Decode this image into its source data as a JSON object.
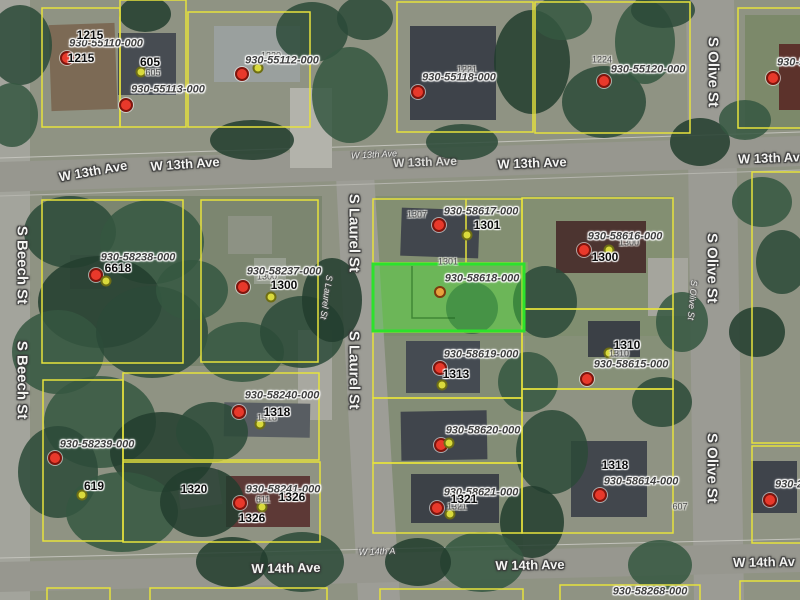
{
  "app": {
    "view": "aerial-parcel-map",
    "selected_parcel_id": "930-58618-000"
  },
  "colors": {
    "parcel_line": "#e6e23c",
    "selected_parcel_stroke": "#2ce22c",
    "selected_parcel_fill": "rgba(70,215,60,0.38)",
    "red_marker": "#e8392b",
    "yellow_marker": "#d9da3c",
    "selected_marker": "#e8a13c"
  },
  "parcel_ids": [
    {
      "text": "930-55110-000"
    },
    {
      "text": "930-55113-000"
    },
    {
      "text": "930-55112-000"
    },
    {
      "text": "930-55118-000"
    },
    {
      "text": "930-55120-000"
    },
    {
      "text": "930-5"
    },
    {
      "text": "930-58238-000"
    },
    {
      "text": "930-58237-000"
    },
    {
      "text": "930-58617-000"
    },
    {
      "text": "930-58616-000"
    },
    {
      "text": "930-58618-000"
    },
    {
      "text": "930-58619-000"
    },
    {
      "text": "930-58615-000"
    },
    {
      "text": "930-58620-000"
    },
    {
      "text": "930-58621-000"
    },
    {
      "text": "930-58239-000"
    },
    {
      "text": "930-58240-000"
    },
    {
      "text": "930-58241-000"
    },
    {
      "text": "930-58614-000"
    },
    {
      "text": "930-2"
    },
    {
      "text": "930-58268-000"
    }
  ],
  "addresses": [
    {
      "text": "1215"
    },
    {
      "text": "1215"
    },
    {
      "text": "605"
    },
    {
      "text": "6618"
    },
    {
      "text": "1300"
    },
    {
      "text": "1301"
    },
    {
      "text": "1300"
    },
    {
      "text": "1310"
    },
    {
      "text": "1313"
    },
    {
      "text": "1318"
    },
    {
      "text": "619"
    },
    {
      "text": "1326"
    },
    {
      "text": "1326"
    },
    {
      "text": "1321"
    },
    {
      "text": "1318"
    },
    {
      "text": "1320"
    }
  ],
  "small_addresses": [
    {
      "text": "1220"
    },
    {
      "text": "1221"
    },
    {
      "text": "1224"
    },
    {
      "text": "605"
    },
    {
      "text": "1307"
    },
    {
      "text": "1301"
    },
    {
      "text": "1300"
    },
    {
      "text": "1300"
    },
    {
      "text": "1310"
    },
    {
      "text": "1318"
    },
    {
      "text": "1321"
    },
    {
      "text": "611"
    },
    {
      "text": "607"
    }
  ],
  "street_labels": [
    {
      "text": "W 13th Ave"
    },
    {
      "text": "W 13th Ave"
    },
    {
      "text": "W 13th Ave"
    },
    {
      "text": "W 13th Ave"
    },
    {
      "text": "W 13th Ave"
    },
    {
      "text": "W 13th Av"
    },
    {
      "text": "W 14th Ave"
    },
    {
      "text": "W 14th A"
    },
    {
      "text": "W 14th Ave"
    },
    {
      "text": "W 14th Av"
    },
    {
      "text": "S Beech St"
    },
    {
      "text": "S Beech St"
    },
    {
      "text": "S Laurel St"
    },
    {
      "text": "S Laurel St"
    },
    {
      "text": "S Laurel St"
    },
    {
      "text": "S Olive St"
    },
    {
      "text": "S Olive St"
    },
    {
      "text": "S Olive St"
    },
    {
      "text": "S Olive St"
    }
  ]
}
